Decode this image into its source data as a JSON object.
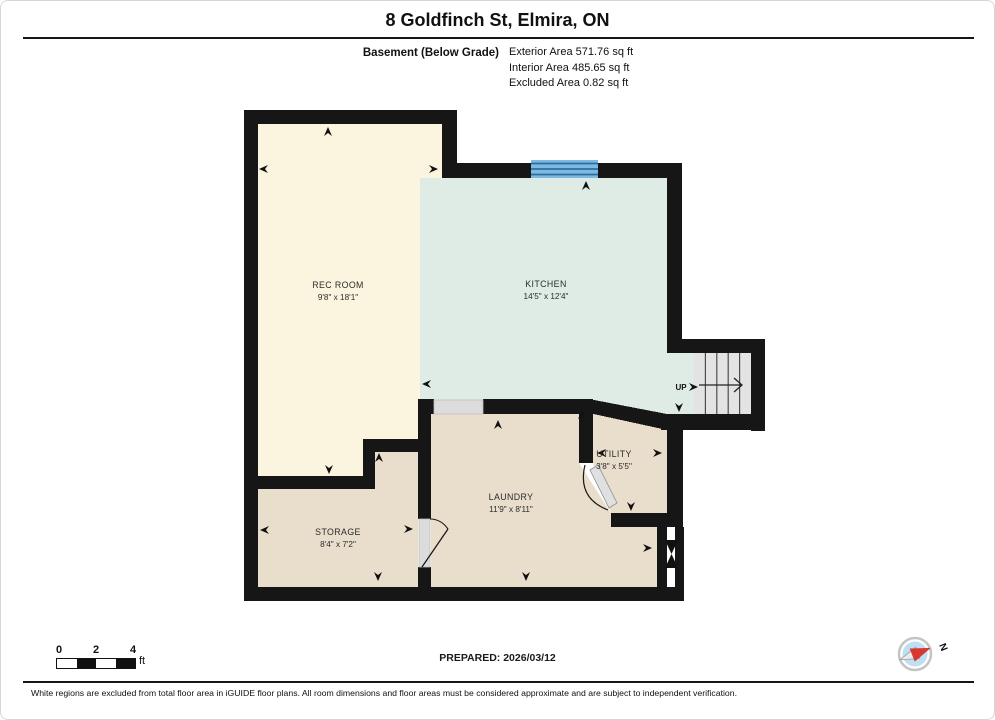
{
  "header": {
    "title": "8 Goldfinch St, Elmira, ON",
    "floor_label": "Basement (Below Grade)",
    "areas": [
      "Exterior Area 571.76 sq ft",
      "Interior Area 485.65 sq ft",
      "Excluded Area 0.82 sq ft"
    ]
  },
  "plan": {
    "rooms": [
      {
        "name": "REC ROOM",
        "dims": "9'8\" x 18'1\"",
        "fill": "#FBF4DF"
      },
      {
        "name": "KITCHEN",
        "dims": "14'5\" x 12'4\"",
        "fill": "#DFECE5"
      },
      {
        "name": "UTILITY",
        "dims": "3'8\" x 5'5\"",
        "fill": "#E8DECB"
      },
      {
        "name": "LAUNDRY",
        "dims": "11'9\" x 8'11\"",
        "fill": "#E8DECB"
      },
      {
        "name": "STORAGE",
        "dims": "8'4\" x 7'2\"",
        "fill": "#E8DECB"
      }
    ],
    "stairs_label": "UP",
    "colors": {
      "wall": "#161616",
      "stairs_fill": "#E3E3E3",
      "window_fill": "#7EB9DF",
      "window_line": "#2D6DA3",
      "opening_fill": "#DCDCDC",
      "door_leaf_fill": "#E0E0E0",
      "excluded_fill": "#FFFFFF"
    }
  },
  "compass": {
    "north_label": "N"
  },
  "scale_bar": {
    "ticks": [
      "0",
      "2",
      "4"
    ],
    "unit": "ft"
  },
  "footer": {
    "prepared": "PREPARED: 2026/03/12",
    "disclaimer": "White regions are excluded from total floor area in iGUIDE floor plans. All room dimensions and floor areas must be considered approximate and are subject to independent verification."
  }
}
